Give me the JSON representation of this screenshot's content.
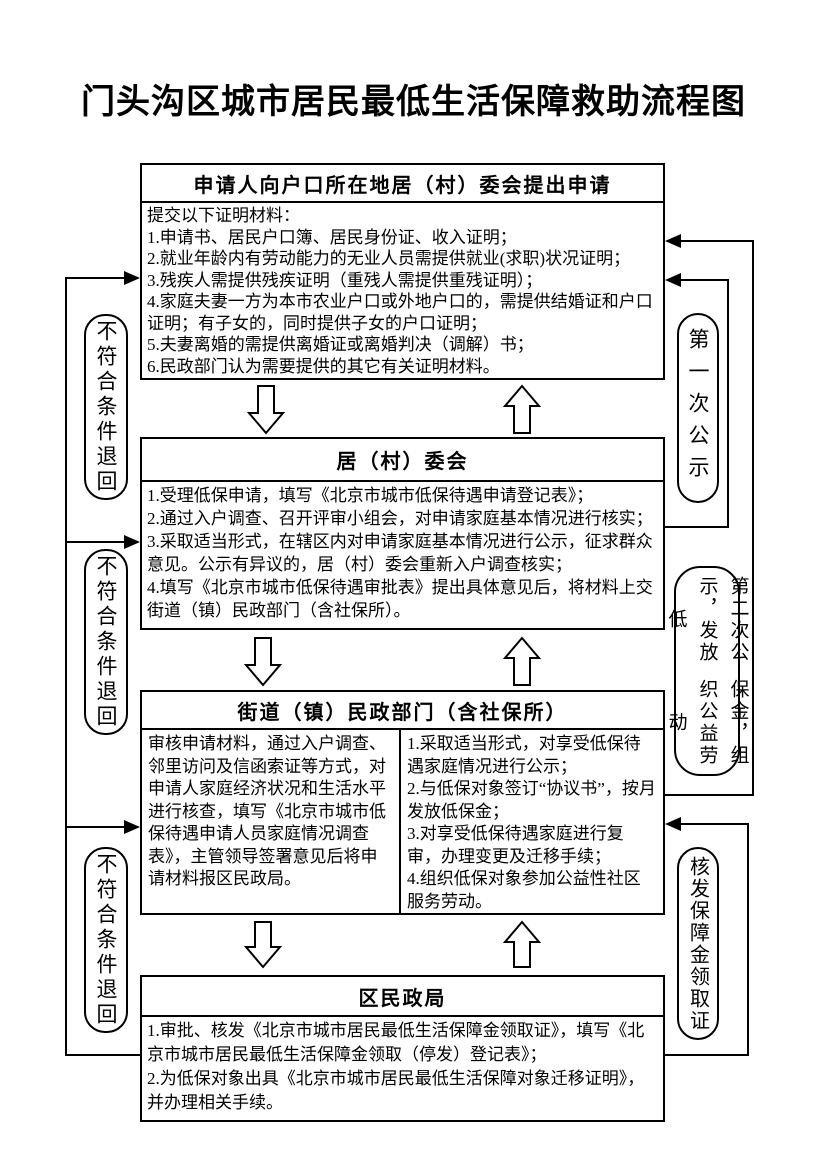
{
  "title": "门头沟区城市居民最低生活保障救助流程图",
  "boxes": [
    {
      "header": "申请人向户口所在地居（村）委会提出申请",
      "lines": [
        "提交以下证明材料：",
        "1.申请书、居民户口簿、居民身份证、收入证明；",
        "2.就业年龄内有劳动能力的无业人员需提供就业(求职)状况证明；",
        "3.残疾人需提供残疾证明（重残人需提供重残证明）；",
        "4.家庭夫妻一方为本市农业户口或外地户口的，需提供结婚证和户口证明；有子女的，同时提供子女的户口证明；",
        "5.夫妻离婚的需提供离婚证或离婚判决（调解）书；",
        "6.民政部门认为需要提供的其它有关证明材料。"
      ]
    },
    {
      "header": "居（村）委会",
      "lines": [
        "1.受理低保申请，填写《北京市城市低保待遇申请登记表》；",
        "2.通过入户调查、召开评审小组会，对申请家庭基本情况进行核实；",
        "3.采取适当形式，在辖区内对申请家庭基本情况进行公示，征求群众意见。公示有异议的，居（村）委会重新入户调查核实；",
        "4.填写《北京市城市低保待遇审批表》提出具体意见后，将材料上交街道（镇）民政部门（含社保所）。"
      ]
    },
    {
      "header": "街道（镇）民政部门（含社保所）",
      "left_lines": [
        "审核申请材料，通过入户调查、邻里访问及信函索证等方式，对申请人家庭经济状况和生活水平进行核查，填写《北京市城市低保待遇申请人员家庭情况调查表》，主管领导签署意见后将申请材料报区民政局。"
      ],
      "right_lines": [
        "1.采取适当形式，对享受低保待遇家庭情况进行公示；",
        "2.与低保对象签订“协议书”，按月发放低保金；",
        "3.对享受低保待遇家庭进行复审，办理变更及迁移手续；",
        "4.组织低保对象参加公益性社区服务劳动。"
      ]
    },
    {
      "header": "区民政局",
      "lines": [
        "1.审批、核发《北京市城市居民最低生活保障金领取证》，填写《北京市城市居民最低生活保障金领取（停发）登记表》；",
        "2.为低保对象出具《北京市城市居民最低生活保障对象迁移证明》，并办理相关手续。"
      ]
    }
  ],
  "side_labels": {
    "left": [
      "不符合条件退回",
      "不符合条件退回",
      "不符合条件退回"
    ],
    "right": [
      "第一次公示",
      "第二次公示，发放低保金，组织公益劳动",
      "核发保障金领取证"
    ],
    "right_label_2_columns": [
      "第二次公示，发放低",
      "保金，组织公益劳动"
    ]
  },
  "colors": {
    "line": "#000000",
    "background": "#ffffff"
  }
}
